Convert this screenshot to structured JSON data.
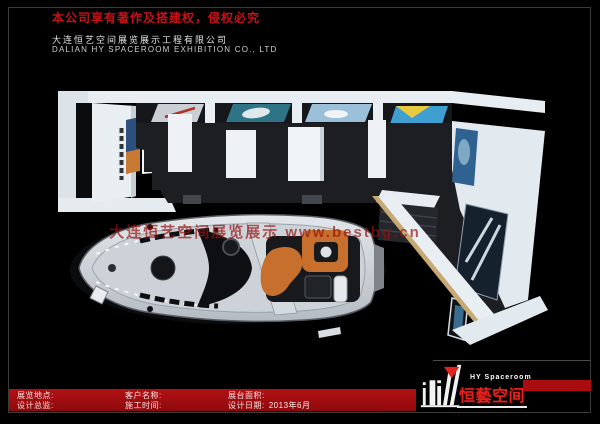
{
  "header": {
    "warning": "本公司享有著作及搭建权，侵权必究",
    "company_cn": "大连恒艺空间展览展示工程有限公司",
    "company_en": "DALIAN HY SPACEROOM EXHIBITION CO., LTD"
  },
  "scene": {
    "watermark": "大连恒艺空间展览展示 www.bestbg.cn",
    "subject_icons": [
      "exhibition-booth-top-view",
      "yacht-model"
    ]
  },
  "info_bar": {
    "col1": {
      "row1": "展览地点:",
      "row2": "设计总监:"
    },
    "col2": {
      "row1": "客户名称:",
      "row2": "施工时间:"
    },
    "col3": {
      "row1": "展台面积:",
      "row2_label": "设计日期:",
      "row2_value": "2013年6月"
    }
  },
  "logo": {
    "name_en": "HY Spaceroom",
    "name_cn": "恒藝空间"
  },
  "colors": {
    "background": "#000000",
    "warning_red": "#c41318",
    "bar_red": "#a90d10",
    "logo_red": "#e2231d",
    "wall_white": "#e9eef3",
    "floor_charcoal": "#1c1e21",
    "seat_orange": "#c7702e"
  }
}
